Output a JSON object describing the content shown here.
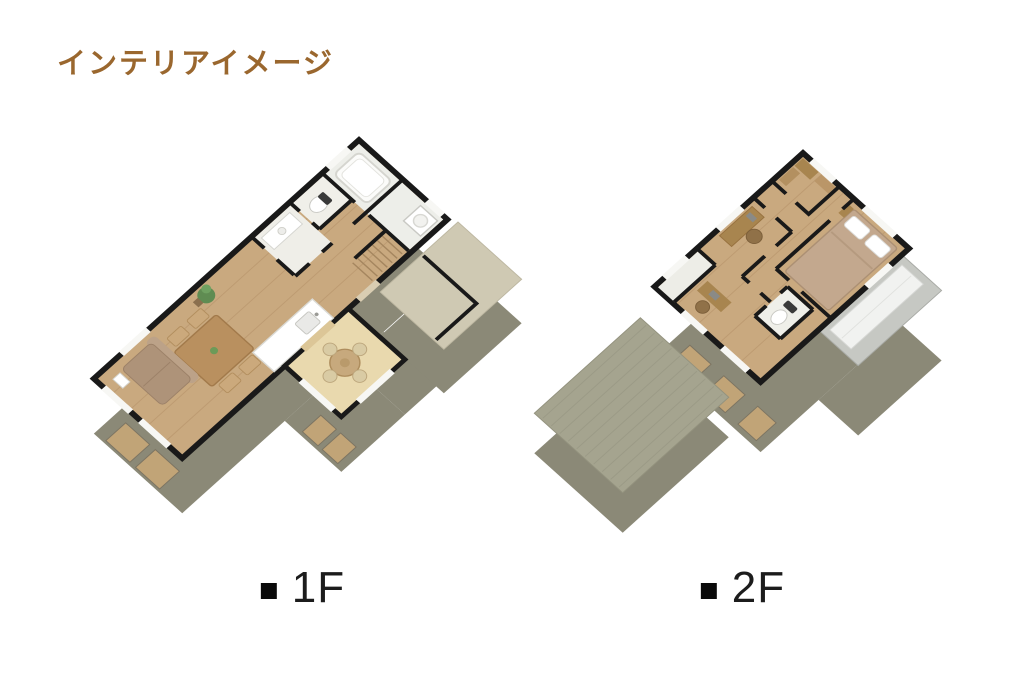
{
  "title": {
    "text": "インテリアイメージ",
    "color": "#9A672E"
  },
  "floor_plans": [
    {
      "id": "floor-1",
      "marker": "■",
      "label": "1F"
    },
    {
      "id": "floor-2",
      "marker": "■",
      "label": "2F"
    }
  ],
  "palette": {
    "background": "#FFFFFF",
    "title_brown": "#9A672E",
    "label_black": "#1C1C1C",
    "wall_black": "#191919",
    "wood_floor": "#C9A97F",
    "wood_plank_line": "#BD9B72",
    "white_room_floor": "#EFEEE9",
    "tatami_nook_floor": "#E9D9AE",
    "exterior_wall_khaki": "#8B8977",
    "window_frame_tan": "#C1A477",
    "entrance_eave_beige": "#CFC9B3",
    "roof_green_gray": "#A5A48F",
    "roof_stripe": "#9B9A86",
    "balcony_gray": "#C6C8C3",
    "bed_cover_tan": "#C3A88E",
    "sofa_tan": "#AE9379",
    "table_wood": "#B9905F",
    "plant_green": "#5F8C52"
  }
}
